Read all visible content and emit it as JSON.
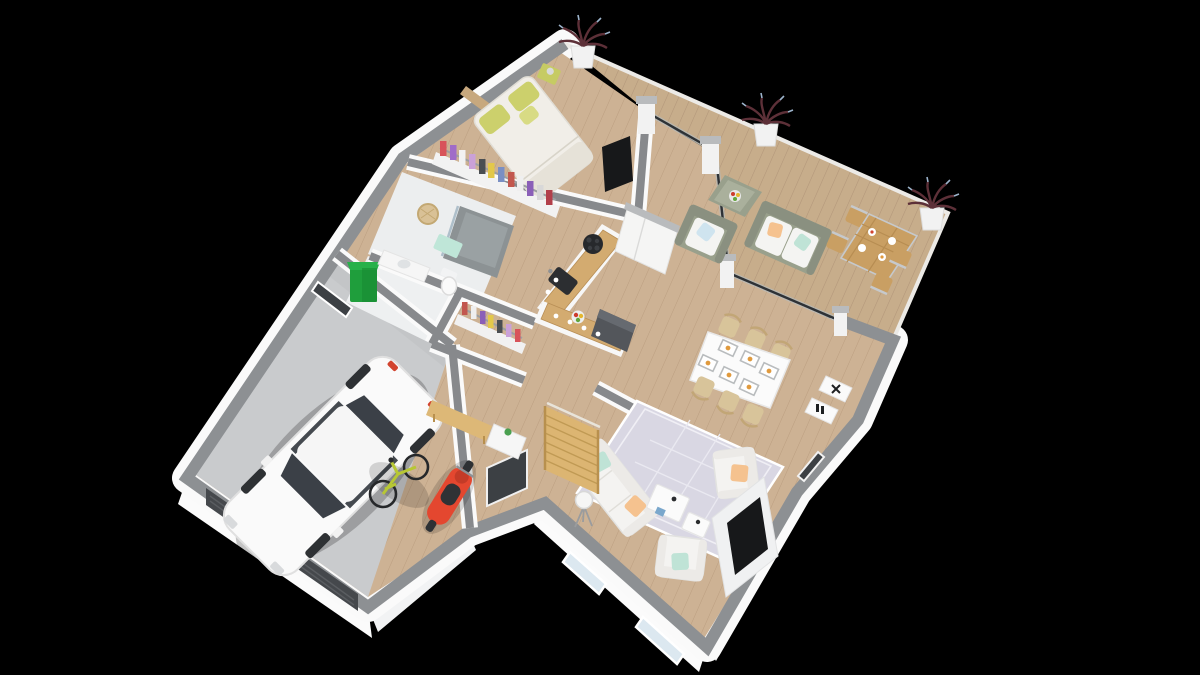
{
  "scene": {
    "type": "3d-floorplan-render",
    "description": "Isometric dollhouse 3D render of a single-storey house floor plan on a black background",
    "background": "#000000",
    "view": "cutaway walls, top-down oblique"
  },
  "palette": {
    "background": "#000000",
    "deckWood": "#c7ad8b",
    "deckPlank": "#b2967a",
    "interiorWood": "#cdb294",
    "interiorPlank": "#bb9e80",
    "garageFloor": "#c9cbcd",
    "concretePad": "#c3c5c1",
    "wallCap": "#8d9093",
    "wallFace": "#fafafa",
    "foundation": "#f4f5f6",
    "innerWallCap": "#87898c",
    "glassFrame": "#2e3236",
    "glassTint": "#aebfca",
    "pierWhite": "#f2f2f2",
    "pierCap": "#b9bbbd",
    "bedDuvet": "#f1eee8",
    "bedBlanket": "#e6e2d8",
    "pillowYellow": "#ccd06c",
    "headboard": "#c7a87e",
    "nightstand": "#c6cb63",
    "wardrobeBase": "#f2f2f2",
    "railGray": "#9c9fa2",
    "bathFloor": "#eceeef",
    "showerTile": "#8c9294",
    "matMint": "#bfe6d8",
    "basketTan": "#d9c196",
    "counterWood": "#d3ab70",
    "counterEdge": "#b88e55",
    "applianceDark": "#53565b",
    "cooktopBlack": "#27292c",
    "sinkBlack": "#2c2e31",
    "cabinetWhite": "#f5f5f4",
    "tableWhite": "#fbfbfb",
    "chairWood": "#d8c49a",
    "chairWoodDark": "#c2a676",
    "sofaWhite": "#f4f3f1",
    "sofaShade": "#eceae7",
    "pillowMint": "#bfe3d6",
    "pillowPeach": "#f5c28f",
    "pillowBlue": "#cfe4ef",
    "rug": "#d9d7e3",
    "rugLine": "#f0eff5",
    "tvBlack": "#17181a",
    "mediaPanel": "#f0f1f2",
    "stairsWood": "#dcb572",
    "stairsTread": "#c09a54",
    "benchWood": "#ddb877",
    "doorDark": "#3c4044",
    "garageDoor": "#45484c",
    "carWhite": "#fafafa",
    "carGlass": "#3b4047",
    "wheelDark": "#2e3134",
    "bikeGreen": "#b7c734",
    "bikeWheel": "#26282a",
    "scooterRed": "#e4472f",
    "binGreen": "#1f9e3c",
    "binLid": "#28b14a",
    "wicker": "#99a08c",
    "wickerDark": "#8a9080",
    "outdoorTableWood": "#c99f63",
    "metalFrame": "#c6c9cc",
    "plantFoliage": "#5d3038",
    "plantTip": "#9db4cc",
    "potWhite": "#f2f2f2",
    "windowGlass": "#dce8f0",
    "darkWindow": "#3c4044",
    "clothes": [
      "#d8535a",
      "#a06cc8",
      "#f2f2f2",
      "#caa1d8",
      "#4a4e52",
      "#e3c84a",
      "#7a8fc4",
      "#c2574e",
      "#efefef",
      "#8a5fb8",
      "#d8d8d8",
      "#b23f4a"
    ]
  },
  "rooms": [
    {
      "id": "terrace",
      "label": "terrace deck",
      "floor": "wood decking",
      "items": [
        "potted plant x3",
        "wicker armchair",
        "wicker loveseat with cushions",
        "wicker coffee table with fruit bowl",
        "outdoor dining table with place settings",
        "4 outdoor chairs",
        "glass wall to living room",
        "concrete entry pad"
      ]
    },
    {
      "id": "bedroom",
      "label": "bedroom",
      "floor": "wood",
      "items": [
        "double bed with white duvet",
        "yellow pillows",
        "headboard",
        "yellow nightstand with lamp",
        "open wardrobe with hanging clothes",
        "wall TV"
      ]
    },
    {
      "id": "bathroom",
      "label": "bathroom",
      "floor": "white tile",
      "items": [
        "walk-in shower",
        "vanity counter",
        "laundry basket",
        "mint bath mat"
      ]
    },
    {
      "id": "wc",
      "label": "WC",
      "floor": "white tile",
      "items": [
        "toilet"
      ]
    },
    {
      "id": "dressing",
      "label": "entry closet",
      "floor": "wood",
      "items": [
        "clothes rail with hanging clothes"
      ]
    },
    {
      "id": "kitchen",
      "label": "kitchen",
      "floor": "wood",
      "items": [
        "L-shaped counter with wood top",
        "black cooktop",
        "black sink",
        "fruit bowl",
        "dark appliance block",
        "tall white cabinet"
      ]
    },
    {
      "id": "dining",
      "label": "dining area",
      "floor": "wood",
      "items": [
        "white dining table",
        "6 wooden chairs",
        "6 placemats with food",
        "white sideboards with decor"
      ]
    },
    {
      "id": "living",
      "label": "living room",
      "floor": "wood",
      "items": [
        "white 3-seat sofa",
        "2 white armchairs",
        "mint and peach cushions",
        "white coffee table set",
        "trellis rug",
        "tripod floor lamp",
        "wall-mounted TV on media panel",
        "2 windows"
      ]
    },
    {
      "id": "entry",
      "label": "entry hall",
      "floor": "wood",
      "items": [
        "wooden staircase",
        "wood bench",
        "white shoe cabinet with plant",
        "dark front door"
      ]
    },
    {
      "id": "garage",
      "label": "garage",
      "floor": "concrete",
      "items": [
        "white car",
        "yellow-green bicycle",
        "red scooter",
        "green wheelie bin",
        "dark garage door",
        "side window"
      ]
    }
  ]
}
